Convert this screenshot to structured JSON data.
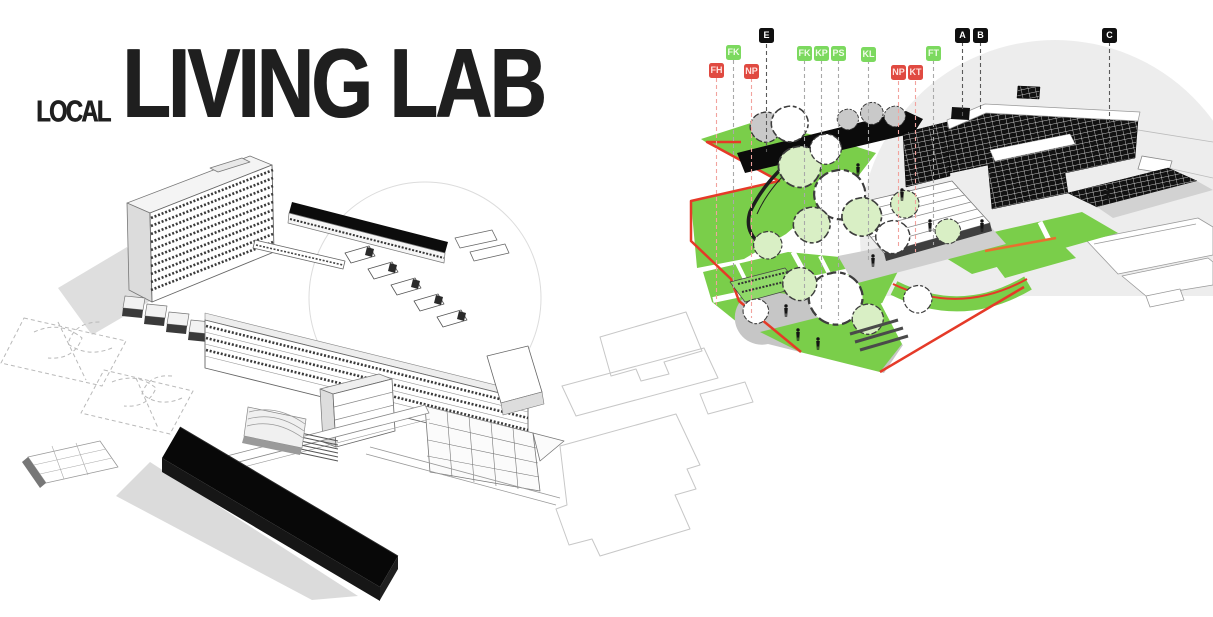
{
  "title": {
    "prefix": "LOCAL",
    "main": "LIVING LAB"
  },
  "palette": {
    "marker_red": "#e04a41",
    "marker_green": "#7cd95f",
    "marker_black": "#101010",
    "leader_red": "#f2a39e",
    "leader_gray": "#a9a9a9",
    "leader_dark": "#5a5a5a",
    "lawn_green": "#7ace4a",
    "path_red": "#e53a28",
    "accent_orange": "#e8702e",
    "walkway_gray": "#c6c6c6",
    "site_disc_gray": "#ededed",
    "building_black": "#0d0d0d"
  },
  "diagram": {
    "markers": [
      {
        "label": "FH",
        "chip_class": "chip chip-red"
      },
      {
        "label": "FK",
        "chip_class": "chip chip-green"
      },
      {
        "label": "NP",
        "chip_class": "chip chip-red"
      },
      {
        "label": "E",
        "chip_class": "chip chip-black"
      },
      {
        "label": "FK",
        "chip_class": "chip chip-green"
      },
      {
        "label": "KP",
        "chip_class": "chip chip-green"
      },
      {
        "label": "PS",
        "chip_class": "chip chip-green"
      },
      {
        "label": "KL",
        "chip_class": "chip chip-green"
      },
      {
        "label": "NP",
        "chip_class": "chip chip-red"
      },
      {
        "label": "KT",
        "chip_class": "chip chip-red"
      },
      {
        "label": "FT",
        "chip_class": "chip chip-green"
      },
      {
        "label": "A",
        "chip_class": "chip chip-black"
      },
      {
        "label": "B",
        "chip_class": "chip chip-black"
      },
      {
        "label": "C",
        "chip_class": "chip chip-black"
      }
    ]
  }
}
